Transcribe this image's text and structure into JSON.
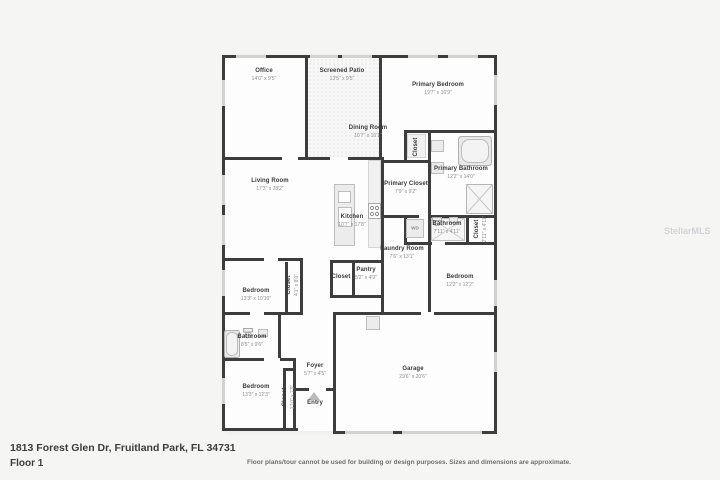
{
  "footer": {
    "address": "1813 Forest Glen Dr, Fruitland Park, FL 34731",
    "floor_label": "Floor 1",
    "disclaimer": "Floor plans/tour cannot be used for building or design purposes. Sizes and dimensions are approximate.",
    "watermark": "StellarMLS"
  },
  "floorplan": {
    "wall_color": "#3d3d3d",
    "wd_label": "WD",
    "rooms": [
      {
        "name": "Office",
        "dims": "14'0\" x 9'5\""
      },
      {
        "name": "Screened Patio",
        "dims": "13'5\" x 9'5\""
      },
      {
        "name": "Primary Bedroom",
        "dims": "19'7\" x 16'9\""
      },
      {
        "name": "Dining Room",
        "dims": "10'7\" x 10'1\""
      },
      {
        "name": "Living Room",
        "dims": "17'3\" x 28'2\""
      },
      {
        "name": "Primary Closet",
        "dims": "7'9\" x 9'2\""
      },
      {
        "name": "Primary Bathroom",
        "dims": "12'2\" x 14'0\""
      },
      {
        "name": "Kitchen",
        "dims": "10'7\" x 17'8\""
      },
      {
        "name": "Closet",
        "dims": ""
      },
      {
        "name": "Bathroom",
        "dims": "7'11\" x 4'11\""
      },
      {
        "name": "Closet",
        "dims": "2'11\" x 4'11\""
      },
      {
        "name": "Laundry Room",
        "dims": "7'6\" x 13'1\""
      },
      {
        "name": "Closet",
        "dims": ""
      },
      {
        "name": "Pantry",
        "dims": "5'2\" x 4'9\""
      },
      {
        "name": "Bedroom",
        "dims": "12'2\" x 12'2\""
      },
      {
        "name": "Bedroom",
        "dims": "13'3\" x 10'10\""
      },
      {
        "name": "Closet",
        "dims": "4'1\" x 8'0\""
      },
      {
        "name": "Bathroom",
        "dims": "8'5\" x 9'6\""
      },
      {
        "name": "Bedroom",
        "dims": "13'3\" x 12'3\""
      },
      {
        "name": "Closet",
        "dims": "1'10\" x 7'9\""
      },
      {
        "name": "Foyer",
        "dims": "5'7\" x 4'5\""
      },
      {
        "name": "Entry",
        "dims": ""
      },
      {
        "name": "Garage",
        "dims": "29'6\" x 20'6\""
      }
    ]
  }
}
